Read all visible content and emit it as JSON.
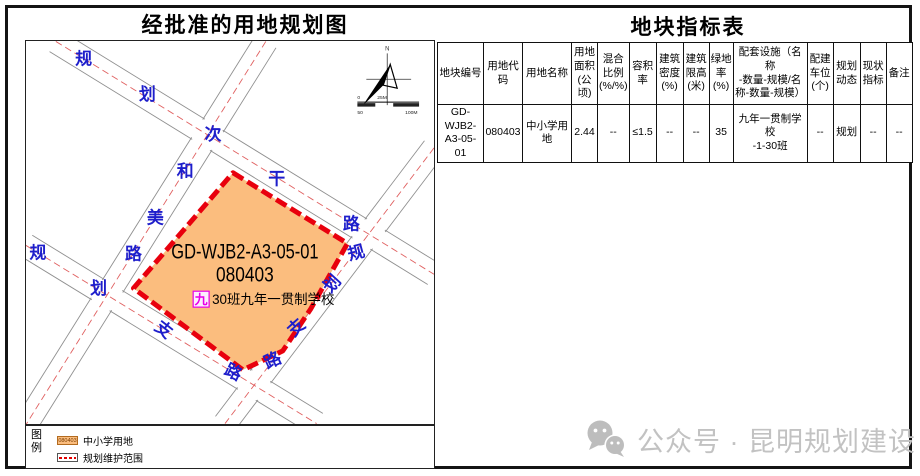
{
  "left_panel": {
    "title": "经批准的用地规划图",
    "map": {
      "parcel_id": "GD-WJB2-A3-05-01",
      "parcel_code": "080403",
      "badge": "九",
      "facility": "30班九年一贯制学校",
      "roads": {
        "north": [
          "规",
          "划",
          "次",
          "干",
          "路"
        ],
        "hemei": [
          "和",
          "美",
          "路"
        ],
        "west": [
          "规",
          "划",
          "支",
          "路"
        ],
        "east": [
          "规",
          "划",
          "支",
          "路"
        ]
      },
      "compass": "N",
      "scale": [
        "0",
        "25M",
        "50",
        "100M"
      ]
    },
    "legend": {
      "chars": [
        "图",
        "例"
      ],
      "items": [
        {
          "swatch": "080403",
          "label": "中小学用地"
        },
        {
          "swatch": "",
          "label": "规划维护范围"
        }
      ]
    }
  },
  "right_panel": {
    "title": "地块指标表",
    "table": {
      "headers": [
        "地块编号",
        "用地代\n码",
        "用地名称",
        "用地\n面积\n(公顷)",
        "混合\n比例\n(%/%)",
        "容积\n率",
        "建筑\n密度\n(%)",
        "建筑\n限高\n(米)",
        "绿地\n率(%)",
        "配套设施（名称\n-数量-规模/名\n称-数量-规模）",
        "配建\n车位\n(个)",
        "规划\n动态",
        "现状\n指标",
        "备注"
      ],
      "row": [
        "GD-WJB2-\nA3-05-01",
        "080403",
        "中小学用地",
        "2.44",
        "--",
        "≤1.5",
        "--",
        "--",
        "35",
        "九年一贯制学校\n-1-30班",
        "--",
        "规划",
        "--",
        "--"
      ]
    }
  },
  "watermark": {
    "icon": "wechat-icon",
    "text": "公众号 · 昆明规划建设"
  },
  "colors": {
    "parcel_fill": "#FBBD7E",
    "parcel_border": "#E8000D",
    "road_label_blue": "#1E1ECB",
    "road_centerline_red": "#E06060",
    "road_edge_gray": "#8f8f8f",
    "badge_magenta": "#E800E8",
    "watermark_gray": "#C2C2C2"
  }
}
